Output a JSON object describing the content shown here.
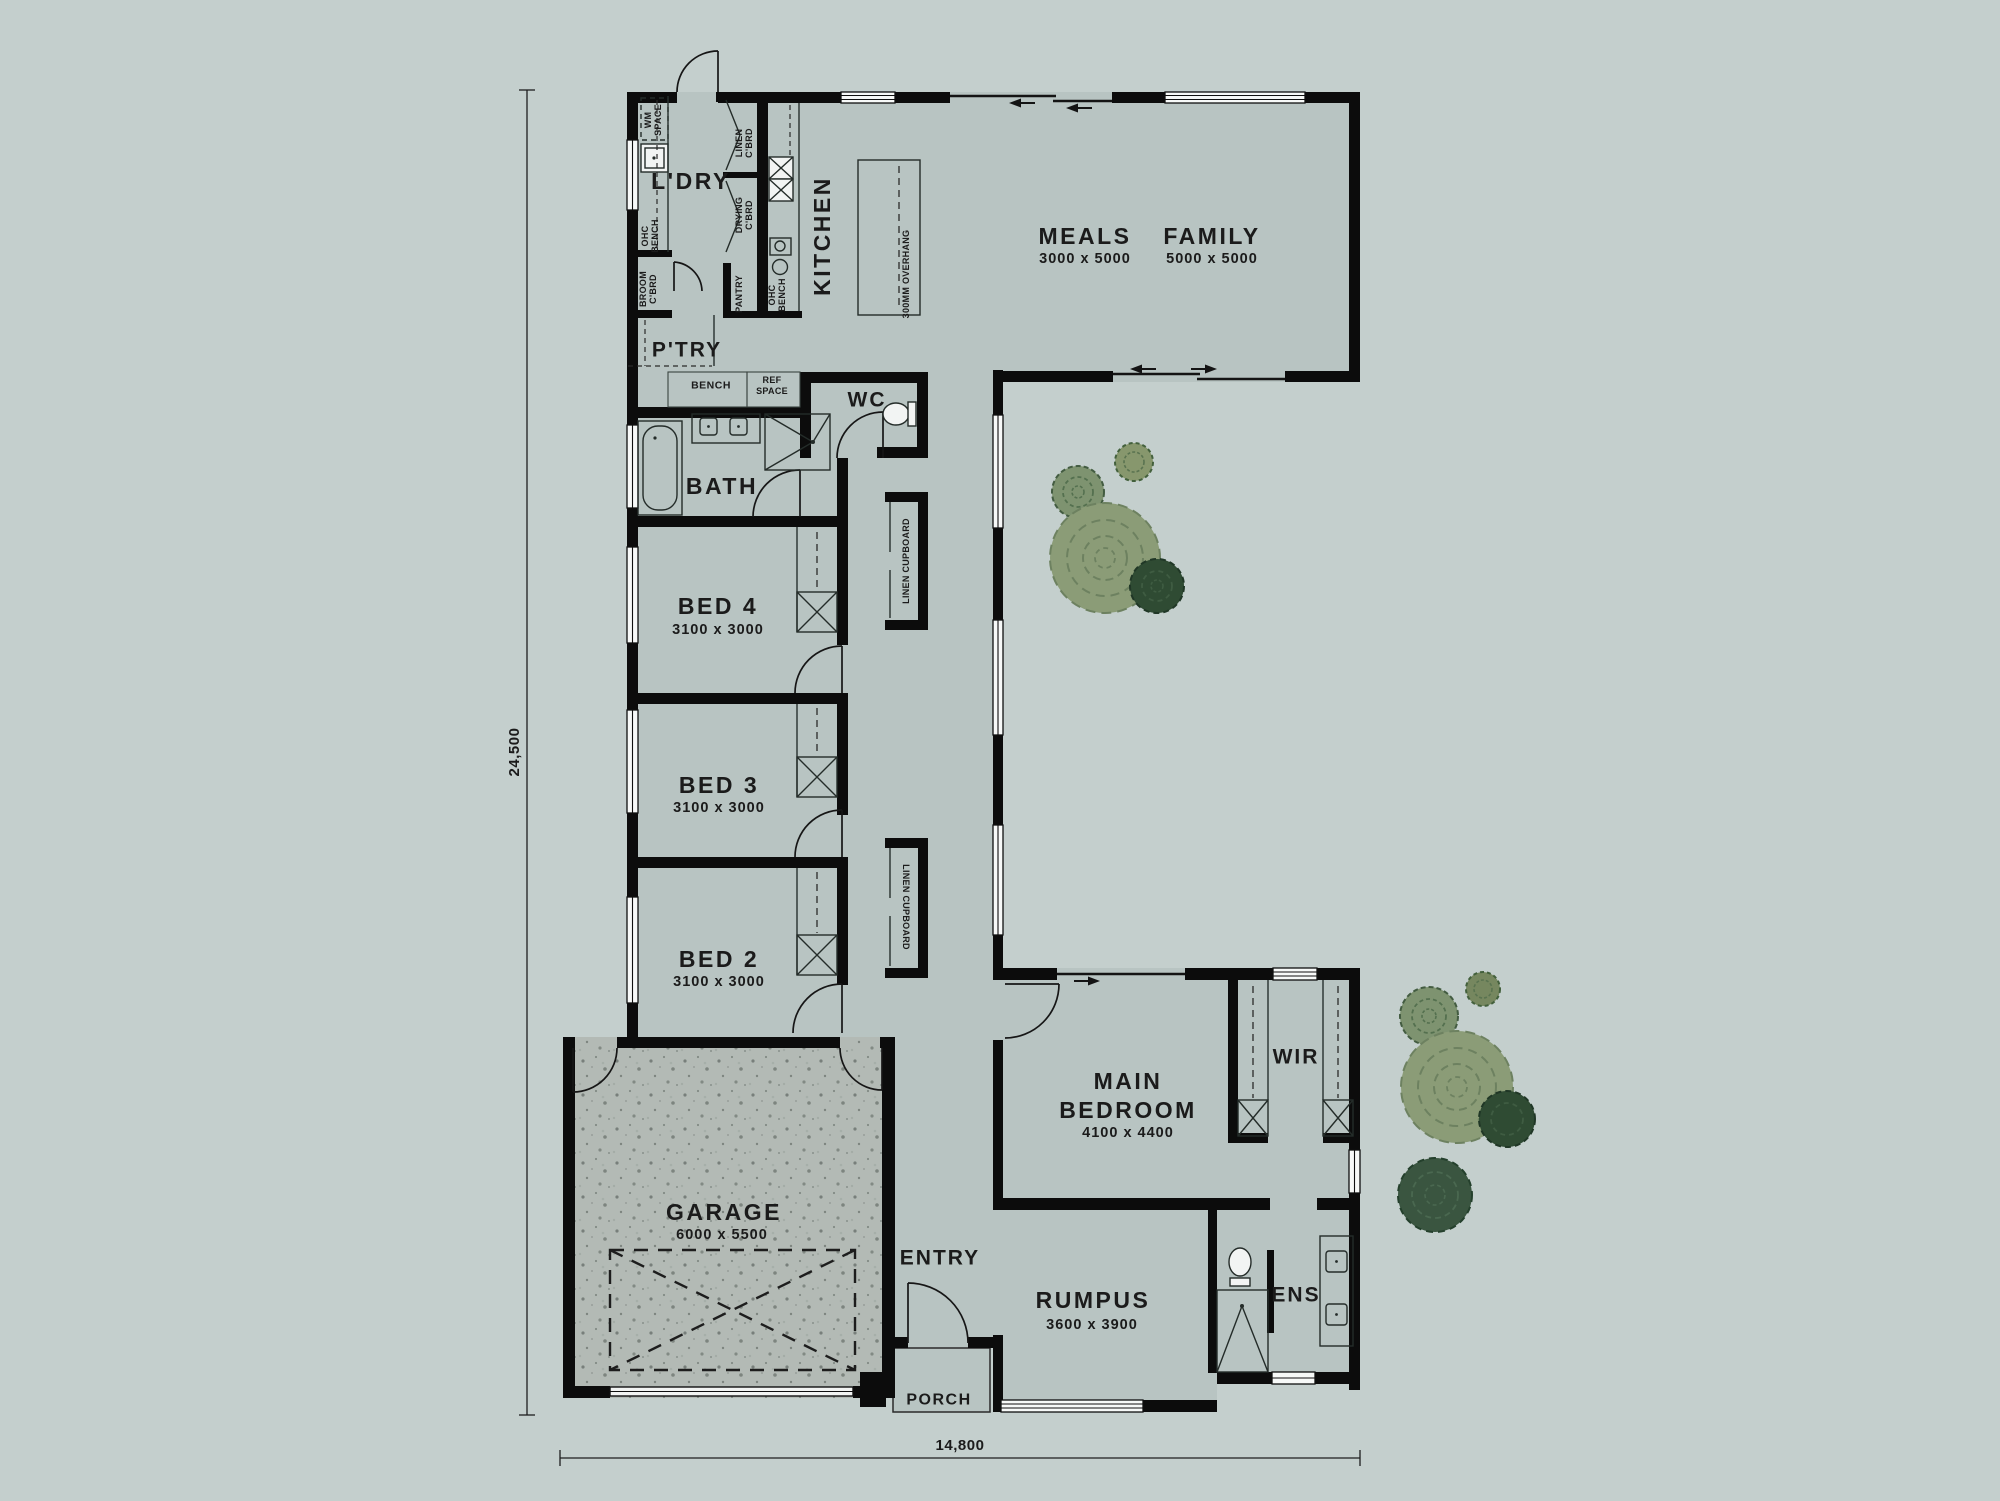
{
  "palette": {
    "bg": "#c4cfcd",
    "floor": "#b8c4c2",
    "garage": "#b3bab5",
    "wall": "#0c0c0c",
    "tree_light": "#8b9c77",
    "tree_mid": "#7e9370",
    "tree_dark": "#2f4b33",
    "tree_dark2": "#3a5540"
  },
  "rooms": {
    "ldry": {
      "label": "L'DRY"
    },
    "ptry": {
      "label": "P'TRY"
    },
    "kitchen": {
      "label": "KITCHEN"
    },
    "meals": {
      "label": "MEALS",
      "dims": "3000 x 5000"
    },
    "family": {
      "label": "FAMILY",
      "dims": "5000 x 5000"
    },
    "wc": {
      "label": "WC"
    },
    "bath": {
      "label": "BATH"
    },
    "bed4": {
      "label": "BED 4",
      "dims": "3100 x 3000"
    },
    "bed3": {
      "label": "BED 3",
      "dims": "3100 x 3000"
    },
    "bed2": {
      "label": "BED 2",
      "dims": "3100 x 3000"
    },
    "garage": {
      "label": "GARAGE",
      "dims": "6000 x 5500"
    },
    "entry": {
      "label": "ENTRY"
    },
    "porch": {
      "label": "PORCH"
    },
    "rumpus": {
      "label": "RUMPUS",
      "dims": "3600 x 3900"
    },
    "ens": {
      "label": "ENS"
    },
    "main_bedroom": {
      "l1": "MAIN",
      "l2": "BEDROOM",
      "dims": "4100 x 4400"
    },
    "wir": {
      "label": "WIR"
    }
  },
  "fixtures": {
    "wm": {
      "l1": "WM",
      "l2": "SPACE"
    },
    "ohc_ldry": {
      "l1": "OHC",
      "l2": "BENCH"
    },
    "broom": {
      "l1": "BROOM",
      "l2": "C'BRD"
    },
    "linen": {
      "l1": "LINEN",
      "l2": "C'BRD"
    },
    "drying": {
      "l1": "DRYING",
      "l2": "C'BRD"
    },
    "pantry": "PANTRY",
    "ohc_kit": {
      "l1": "OHC",
      "l2": "BENCH"
    },
    "overhang": "300MM OVERHANG",
    "bench": "BENCH",
    "ref": {
      "l1": "REF",
      "l2": "SPACE"
    },
    "linen_cupboard_1": "LINEN CUPBOARD",
    "linen_cupboard_2": "LINEN CUPBOARD"
  },
  "dimensions": {
    "height": "24,500",
    "width": "14,800"
  }
}
